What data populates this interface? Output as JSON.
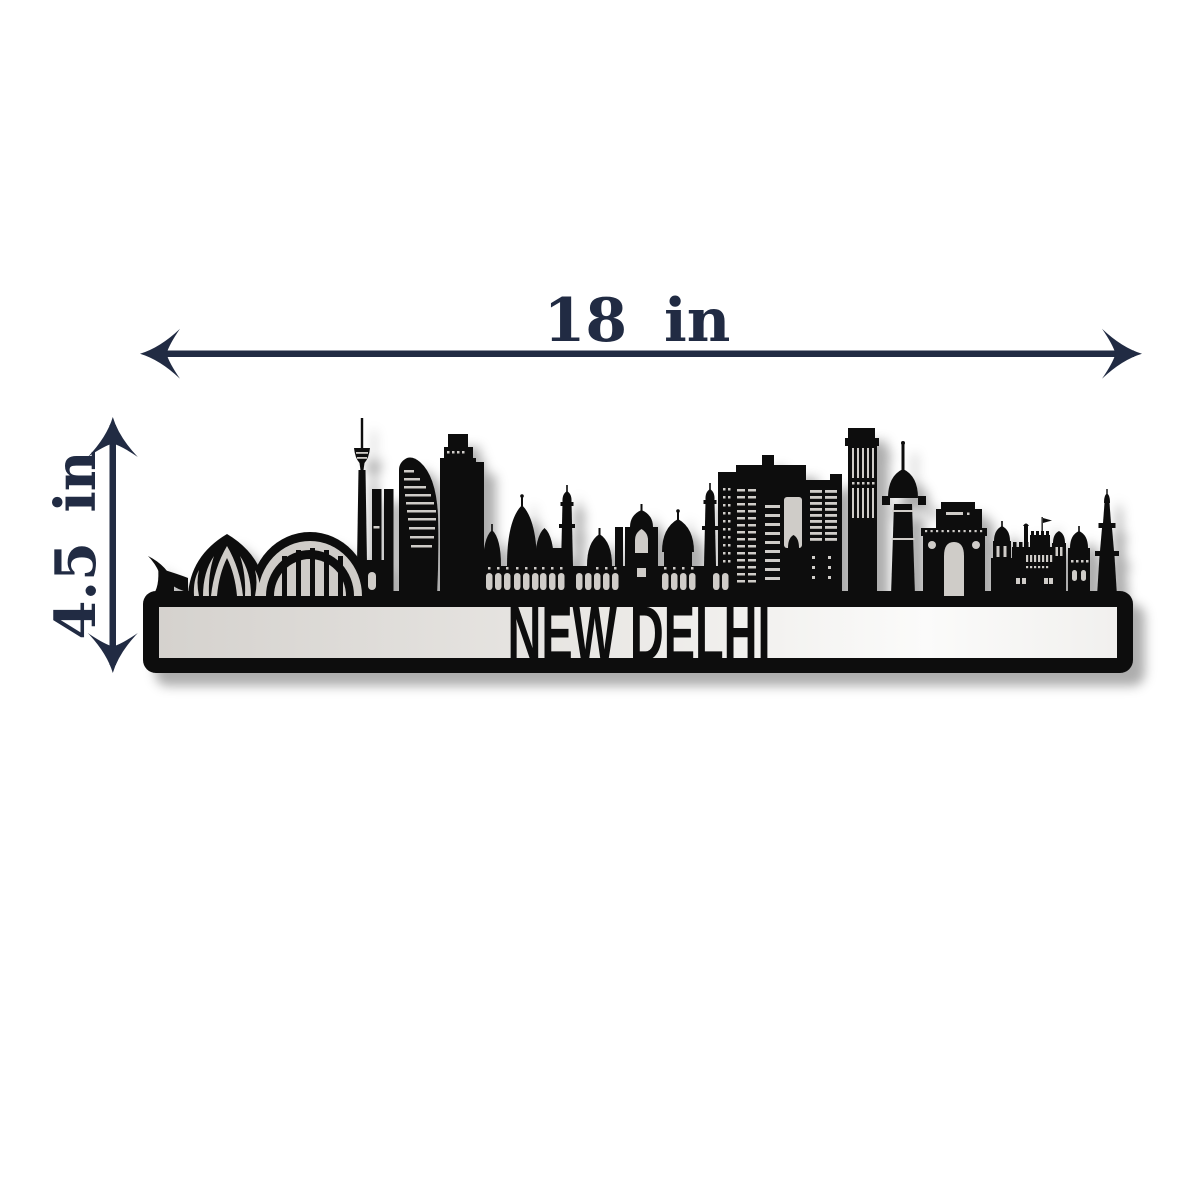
{
  "page": {
    "background_color": "#ffffff"
  },
  "dimensions": {
    "width": {
      "label": "18 in"
    },
    "height": {
      "label": "4.5 in"
    },
    "arrow_color": "#212b43"
  },
  "artwork": {
    "city_label": "NEW DELHI",
    "silhouette_color": "#0b0b0b",
    "cutout_color": "#cfccc8",
    "landmarks": [
      "grass",
      "lotus-temple",
      "stadium-arch",
      "tv-tower",
      "twin-towers",
      "sail-tower",
      "stepped-tower",
      "jama-masjid",
      "gateway-dome",
      "grid-highrise",
      "louver-towers",
      "pinstripe-skyscraper",
      "dome-tower",
      "india-gate",
      "chhatri-pavilion",
      "red-fort",
      "qutub-minar"
    ]
  }
}
